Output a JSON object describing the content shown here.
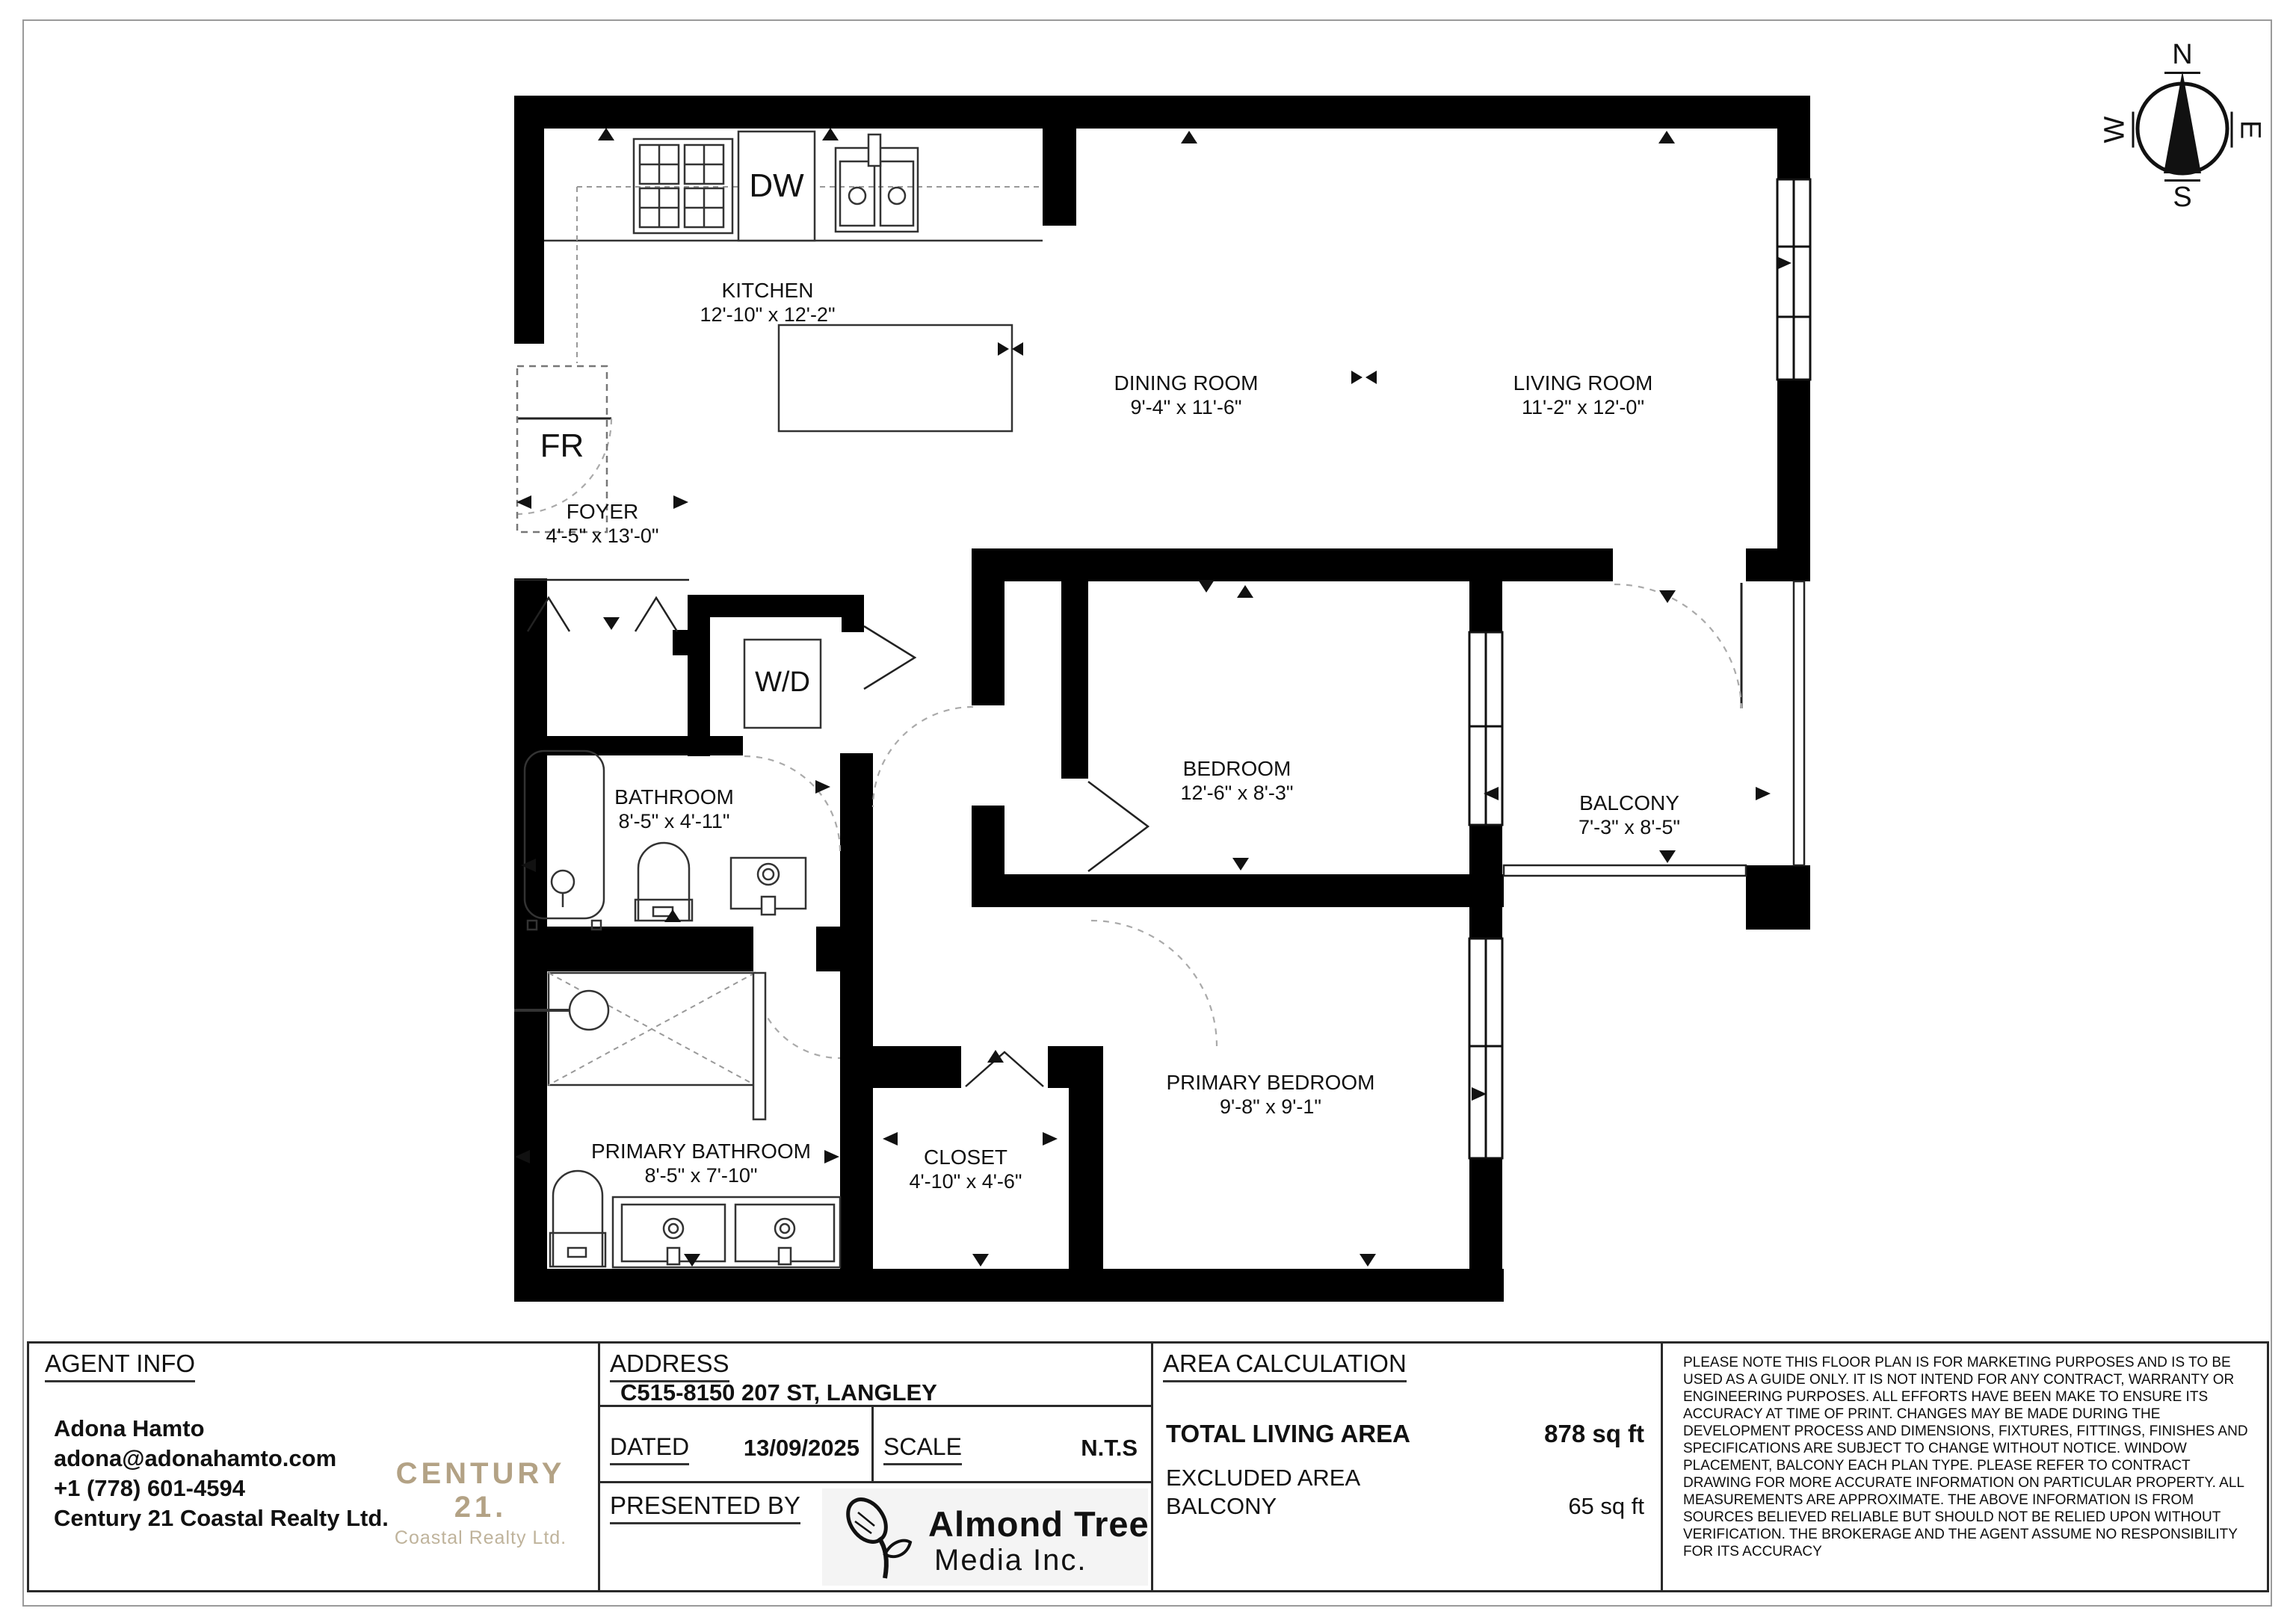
{
  "rooms": {
    "kitchen": {
      "name": "KITCHEN",
      "dims": "12'-10\" x 12'-2\""
    },
    "dining_room": {
      "name": "DINING ROOM",
      "dims": "9'-4\" x 11'-6\""
    },
    "living_room": {
      "name": "LIVING ROOM",
      "dims": "11'-2\" x 12'-0\""
    },
    "foyer": {
      "name": "FOYER",
      "dims": "4'-5\" x 13'-0\""
    },
    "bathroom": {
      "name": "BATHROOM",
      "dims": "8'-5\" x 4'-11\""
    },
    "bedroom": {
      "name": "BEDROOM",
      "dims": "12'-6\" x 8'-3\""
    },
    "balcony": {
      "name": "BALCONY",
      "dims": "7'-3\" x 8'-5\""
    },
    "primary_bathroom": {
      "name": "PRIMARY BATHROOM",
      "dims": "8'-5\" x 7'-10\""
    },
    "closet": {
      "name": "CLOSET",
      "dims": "4'-10\" x 4'-6\""
    },
    "primary_bedroom": {
      "name": "PRIMARY BEDROOM",
      "dims": "9'-8\" x 9'-1\""
    }
  },
  "appliances": {
    "dishwasher": "DW",
    "fridge": "FR",
    "washer_dryer": "W/D"
  },
  "compass": {
    "north": "N",
    "east": "E",
    "south": "S",
    "west": "W"
  },
  "info": {
    "agent": {
      "heading": "AGENT INFO",
      "name": "Adona Hamto",
      "email": "adona@adonahamto.com",
      "phone": "+1 (778) 601-4594",
      "brokerage": "Century 21 Coastal Realty Ltd.",
      "logo_line1": "CENTURY 21.",
      "logo_line2": "Coastal Realty Ltd."
    },
    "address": {
      "heading": "ADDRESS",
      "value": "C515-8150 207 ST, LANGLEY",
      "dated_label": "DATED",
      "dated_value": "13/09/2025",
      "scale_label": "SCALE",
      "scale_value": "N.T.S",
      "presented_label": "PRESENTED BY",
      "presenter_line1": "Almond Tree",
      "presenter_line2": "Media Inc."
    },
    "area": {
      "heading": "AREA CALCULATION",
      "total_label": "TOTAL LIVING AREA",
      "total_value": "878 sq ft",
      "excluded_label": "EXCLUDED AREA",
      "balcony_label": "BALCONY",
      "balcony_value": "65 sq ft"
    },
    "disclaimer": "PLEASE NOTE THIS FLOOR PLAN IS FOR MARKETING PURPOSES AND IS TO BE USED AS A GUIDE ONLY. IT IS NOT INTEND FOR ANY CONTRACT, WARRANTY OR ENGINEERING PURPOSES. ALL EFFORTS HAVE BEEN MAKE TO ENSURE ITS ACCURACY AT TIME OF PRINT. CHANGES MAY BE MADE DURING THE DEVELOPMENT PROCESS AND DIMENSIONS, FIXTURES, FITTINGS, FINISHES AND SPECIFICATIONS ARE SUBJECT TO CHANGE WITHOUT NOTICE. WINDOW PLACEMENT, BALCONY EACH PLAN TYPE. PLEASE REFER TO CONTRACT DRAWING FOR MORE ACCURATE INFORMATION ON PARTICULAR PROPERTY. ALL MEASUREMENTS ARE APPROXIMATE. THE ABOVE INFORMATION IS FROM SOURCES BELIEVED RELIABLE BUT SHOULD NOT BE RELIED UPON WITHOUT VERIFICATION. THE BROKERAGE AND THE AGENT ASSUME NO RESPONSIBILITY FOR ITS ACCURACY"
  },
  "colors": {
    "century21_gold": "#b3a285",
    "wall": "#000000"
  }
}
